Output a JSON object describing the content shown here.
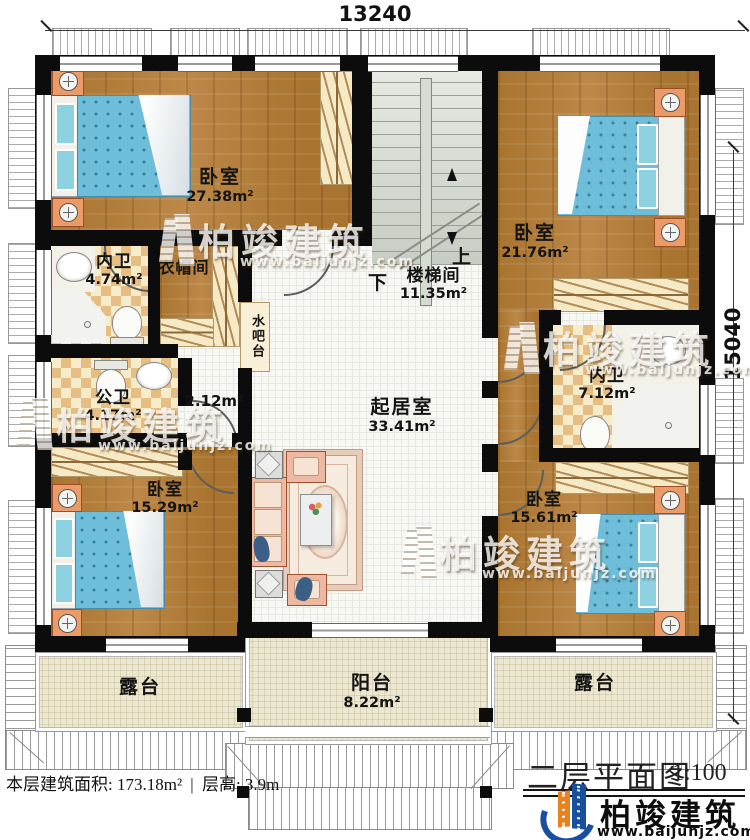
{
  "dimensions": {
    "width_top": "13240",
    "height_right": "15040"
  },
  "rooms": {
    "bedroom_tl": {
      "label": "卧室",
      "area": "27.38m²"
    },
    "bath_tl": {
      "label": "内卫",
      "area": "4.74m²"
    },
    "cloakroom": {
      "label": "衣帽间"
    },
    "water_bar": {
      "label": "水吧台"
    },
    "stairwell": {
      "label": "楼梯间",
      "area": "11.35m²"
    },
    "bedroom_tr": {
      "label": "卧室",
      "area": "21.76m²"
    },
    "bath_tr": {
      "label": "内卫",
      "area": "7.12m²"
    },
    "public_bath": {
      "label": "公卫",
      "area": "4.17m²"
    },
    "small_hall": {
      "area": "2.12m²"
    },
    "living_room": {
      "label": "起居室",
      "area": "33.41m²"
    },
    "bedroom_bl": {
      "label": "卧室",
      "area": "15.29m²"
    },
    "bedroom_br": {
      "label": "卧室",
      "area": "15.61m²"
    },
    "terrace_left": {
      "label": "露台"
    },
    "balcony": {
      "label": "阳台",
      "area": "8.22m²"
    },
    "terrace_right": {
      "label": "露台"
    }
  },
  "stairs": {
    "up_label": "上",
    "down_label": "下"
  },
  "footer": {
    "floor_area_label": "本层建筑面积: 173.18m²",
    "divider": "|",
    "floor_height_label": "层高: 3.9m"
  },
  "title_block": {
    "plan_title": "二层平面图",
    "scale": "1:100"
  },
  "brand": {
    "name": "柏竣建筑",
    "website": "www.baijunjz.com"
  },
  "watermark": {
    "name": "柏竣建筑",
    "website": "www.baijunjz.com"
  },
  "colors": {
    "wall": "#0c0c0c",
    "wood": "#b07b3d",
    "tile_bath": "#e6bd83",
    "bed": "#6fbed9",
    "terrace": "#ece7d0",
    "logo_blue": "#16509f",
    "logo_orange": "#e8821e"
  }
}
